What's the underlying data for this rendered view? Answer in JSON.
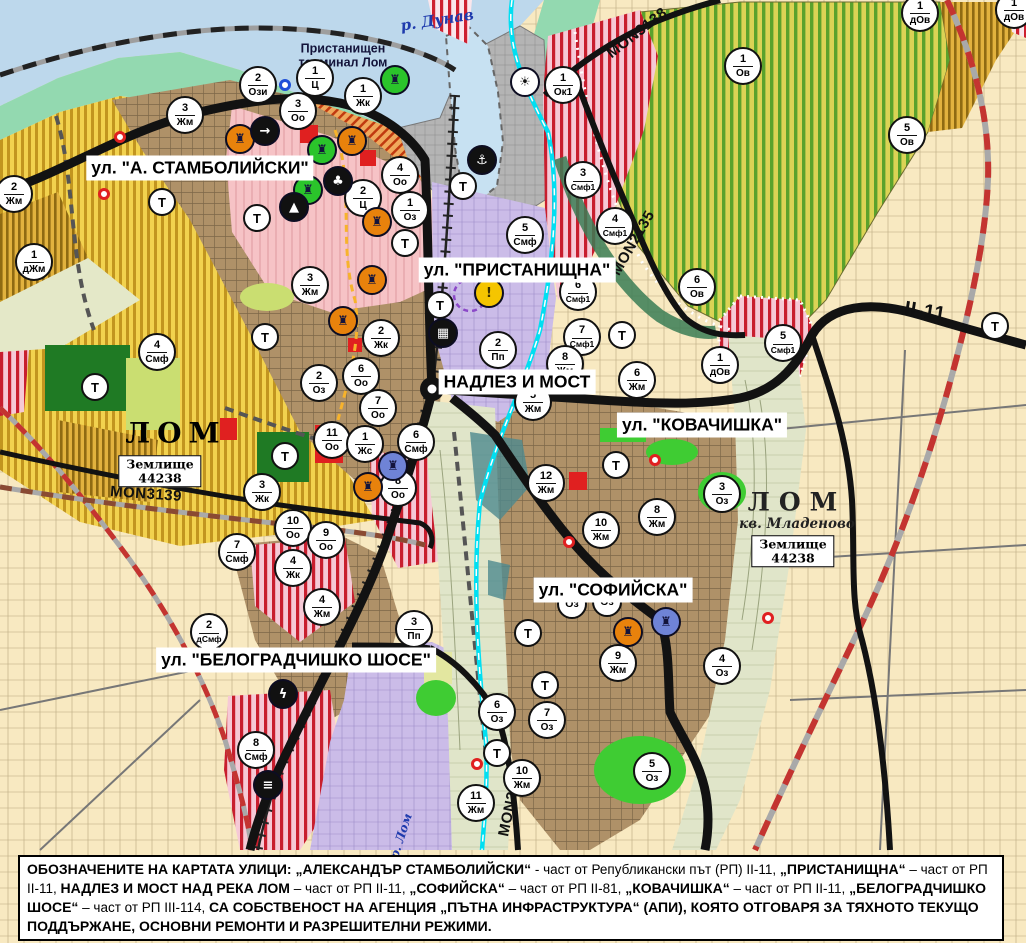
{
  "palette": {
    "water": "#BDD8EC",
    "shore_green": "#93D9B0",
    "port_gray": "#B4B4B4",
    "residential_yellow": "#F2D24E",
    "urban_brown": "#AF9168",
    "center_pink": "#F6C3C6",
    "mixed_red_stripe": "#CE2030",
    "industry_lavender": "#CBBCE8",
    "vineyard_green": "#5AA22C",
    "park_dark_green": "#1F7A24",
    "green_area": "#3FCC33",
    "valley_khaki": "#E0E5C9",
    "road_black": "#121212",
    "rail_red": "#C43430",
    "canal_cyan": "#00DFF2",
    "field_beige": "#F8E9C1"
  },
  "map": {
    "water_label": "р. Дунав",
    "river_lom_label": "р. Лом",
    "port_terminal_label": "Пристанищен\nтерминал Лом",
    "city": {
      "name": "ЛОМ"
    },
    "district": {
      "name": "ЛОМ",
      "sub": "кв. Младеново"
    },
    "land_plots": [
      {
        "line1": "Землище",
        "line2": "44238",
        "x": 160,
        "y": 471
      },
      {
        "line1": "Землище",
        "line2": "44238",
        "x": 793,
        "y": 551
      }
    ],
    "road_labels": [
      {
        "text": "MON3138",
        "x": 637,
        "y": 33,
        "rot": -38,
        "size": 15
      },
      {
        "text": "MON2135",
        "x": 633,
        "y": 243,
        "rot": -60,
        "size": 15
      },
      {
        "text": "MON3139",
        "x": 146,
        "y": 494,
        "rot": 4,
        "size": 15
      },
      {
        "text": "MON2136",
        "x": 511,
        "y": 801,
        "rot": -78,
        "size": 15
      },
      {
        "text": "II-11",
        "x": 925,
        "y": 312,
        "rot": 9,
        "size": 20
      }
    ],
    "street_labels": [
      {
        "text": "ул. \"А. СТАМБОЛИЙСКИ\"",
        "x": 200,
        "y": 168
      },
      {
        "text": "ул. \"ПРИСТАНИЩНА\"",
        "x": 517,
        "y": 270
      },
      {
        "text": "НАДЛЕЗ И МОСТ",
        "x": 517,
        "y": 382
      },
      {
        "text": "ул. \"КОВАЧИШКА\"",
        "x": 702,
        "y": 425
      },
      {
        "text": "ул. \"СОФИЙСКА\"",
        "x": 613,
        "y": 590
      },
      {
        "text": "ул. \"БЕЛОГРАДЧИШКО ШОСЕ\"",
        "x": 296,
        "y": 660
      }
    ],
    "markers": [
      {
        "num": "2",
        "code": "Ози",
        "x": 258,
        "y": 85
      },
      {
        "num": "1",
        "code": "Ц",
        "x": 315,
        "y": 78
      },
      {
        "num": "1",
        "code": "Жк",
        "x": 363,
        "y": 96
      },
      {
        "num": "3",
        "code": "Оо",
        "x": 298,
        "y": 111
      },
      {
        "num": "1",
        "code": "Ок1",
        "x": 563,
        "y": 85
      },
      {
        "num": "3",
        "code": "Жм",
        "x": 185,
        "y": 115
      },
      {
        "num": "2",
        "code": "Жм",
        "x": 14,
        "y": 194
      },
      {
        "num": "1",
        "code": "дЖм",
        "x": 34,
        "y": 262
      },
      {
        "num": "4",
        "code": "Оо",
        "x": 400,
        "y": 175
      },
      {
        "num": "2",
        "code": "Ц",
        "x": 363,
        "y": 198
      },
      {
        "num": "1",
        "code": "Оз",
        "x": 410,
        "y": 210
      },
      {
        "num": "3",
        "code": "Жм",
        "x": 310,
        "y": 285
      },
      {
        "num": "4",
        "code": "Смф",
        "x": 157,
        "y": 352
      },
      {
        "num": "3",
        "code": "Смф1",
        "x": 583,
        "y": 180
      },
      {
        "num": "4",
        "code": "Смф1",
        "x": 615,
        "y": 226
      },
      {
        "num": "5",
        "code": "Смф",
        "x": 525,
        "y": 235
      },
      {
        "num": "6",
        "code": "Смф1",
        "x": 578,
        "y": 292
      },
      {
        "num": "7",
        "code": "Смф1",
        "x": 582,
        "y": 337
      },
      {
        "num": "2",
        "code": "Пп",
        "x": 498,
        "y": 350
      },
      {
        "num": "2",
        "code": "Жк",
        "x": 381,
        "y": 338
      },
      {
        "num": "6",
        "code": "Оо",
        "x": 361,
        "y": 376
      },
      {
        "num": "2",
        "code": "Оз",
        "x": 319,
        "y": 383
      },
      {
        "num": "7",
        "code": "Оо",
        "x": 378,
        "y": 408
      },
      {
        "num": "11",
        "code": "Оо",
        "x": 332,
        "y": 440
      },
      {
        "num": "1",
        "code": "Жс",
        "x": 365,
        "y": 444
      },
      {
        "num": "6",
        "code": "Смф",
        "x": 416,
        "y": 442
      },
      {
        "num": "8",
        "code": "Оо",
        "x": 398,
        "y": 488
      },
      {
        "num": "3",
        "code": "Жк",
        "x": 262,
        "y": 492
      },
      {
        "num": "10",
        "code": "Оо",
        "x": 293,
        "y": 528
      },
      {
        "num": "9",
        "code": "Оо",
        "x": 326,
        "y": 540
      },
      {
        "num": "7",
        "code": "Смф",
        "x": 237,
        "y": 552
      },
      {
        "num": "4",
        "code": "Жк",
        "x": 293,
        "y": 568
      },
      {
        "num": "4",
        "code": "Жм",
        "x": 322,
        "y": 607
      },
      {
        "num": "2",
        "code": "дСмф",
        "x": 209,
        "y": 632
      },
      {
        "num": "3",
        "code": "Пп",
        "x": 414,
        "y": 629
      },
      {
        "num": "8",
        "code": "Смф",
        "x": 256,
        "y": 750
      },
      {
        "num": "5",
        "code": "Жм",
        "x": 533,
        "y": 402
      },
      {
        "num": "8",
        "code": "Жм",
        "x": 565,
        "y": 364
      },
      {
        "num": "6",
        "code": "Жм",
        "x": 637,
        "y": 380
      },
      {
        "num": "12",
        "code": "Жм",
        "x": 546,
        "y": 483
      },
      {
        "num": "10",
        "code": "Жм",
        "x": 601,
        "y": 530
      },
      {
        "num": "8",
        "code": "Жм",
        "x": 657,
        "y": 517
      },
      {
        "num": "3",
        "code": "Оз",
        "x": 722,
        "y": 494
      },
      {
        "num": "10",
        "code": "Жм",
        "x": 522,
        "y": 778
      },
      {
        "num": "11",
        "code": "Жм",
        "x": 476,
        "y": 803
      },
      {
        "num": "9",
        "code": "Жм",
        "x": 618,
        "y": 663
      },
      {
        "num": "6",
        "code": "Оз",
        "x": 497,
        "y": 712
      },
      {
        "num": "7",
        "code": "Оз",
        "x": 547,
        "y": 720
      },
      {
        "num": "5",
        "code": "Оз",
        "x": 652,
        "y": 771
      },
      {
        "num": "4",
        "code": "Оз",
        "x": 722,
        "y": 666
      },
      {
        "num": "1",
        "code": "Ов",
        "x": 743,
        "y": 66
      },
      {
        "num": "5",
        "code": "Ов",
        "x": 907,
        "y": 135
      },
      {
        "num": "6",
        "code": "Ов",
        "x": 697,
        "y": 287
      },
      {
        "num": "1",
        "code": "дОв",
        "x": 920,
        "y": 13
      },
      {
        "num": "1",
        "code": "дОв",
        "x": 1014,
        "y": 10
      },
      {
        "num": "1",
        "code": "дОв",
        "x": 720,
        "y": 365
      },
      {
        "num": "5",
        "code": "Смф1",
        "x": 783,
        "y": 343
      },
      {
        "num": "",
        "code": "Оз",
        "x": 572,
        "y": 604
      },
      {
        "num": "",
        "code": "Оз",
        "x": 607,
        "y": 602
      }
    ],
    "t_markers": [
      {
        "x": 162,
        "y": 202
      },
      {
        "x": 257,
        "y": 218
      },
      {
        "x": 265,
        "y": 337
      },
      {
        "x": 95,
        "y": 387
      },
      {
        "x": 285,
        "y": 456
      },
      {
        "x": 463,
        "y": 186
      },
      {
        "x": 405,
        "y": 243
      },
      {
        "x": 440,
        "y": 305
      },
      {
        "x": 622,
        "y": 335
      },
      {
        "x": 616,
        "y": 465
      },
      {
        "x": 528,
        "y": 633
      },
      {
        "x": 545,
        "y": 685
      },
      {
        "x": 497,
        "y": 753
      },
      {
        "x": 995,
        "y": 326
      }
    ],
    "icons": [
      {
        "type": "monument",
        "x": 240,
        "y": 139,
        "bg": "#E8820C",
        "fg": "#14143C",
        "glyph": "♜"
      },
      {
        "type": "monument",
        "x": 352,
        "y": 141,
        "bg": "#E8820C",
        "fg": "#14143C",
        "glyph": "♜"
      },
      {
        "type": "monument",
        "x": 377,
        "y": 222,
        "bg": "#E8820C",
        "fg": "#14143C",
        "glyph": "♜"
      },
      {
        "type": "monument",
        "x": 372,
        "y": 280,
        "bg": "#E8820C",
        "fg": "#14143C",
        "glyph": "♜"
      },
      {
        "type": "monument",
        "x": 343,
        "y": 321,
        "bg": "#E8820C",
        "fg": "#14143C",
        "glyph": "♜"
      },
      {
        "type": "monument",
        "x": 368,
        "y": 487,
        "bg": "#E8820C",
        "fg": "#14143C",
        "glyph": "♜"
      },
      {
        "type": "monument",
        "x": 628,
        "y": 632,
        "bg": "#E8820C",
        "fg": "#14143C",
        "glyph": "♜"
      },
      {
        "type": "monument",
        "x": 395,
        "y": 80,
        "bg": "#2BC42B",
        "fg": "#14143C",
        "glyph": "♜"
      },
      {
        "type": "monument",
        "x": 322,
        "y": 150,
        "bg": "#2BC42B",
        "fg": "#14143C",
        "glyph": "♜"
      },
      {
        "type": "monument",
        "x": 308,
        "y": 190,
        "bg": "#2BC42B",
        "fg": "#14143C",
        "glyph": "♜"
      },
      {
        "type": "monument",
        "x": 393,
        "y": 466,
        "bg": "#6F83D6",
        "fg": "#14143C",
        "glyph": "♜"
      },
      {
        "type": "monument",
        "x": 666,
        "y": 622,
        "bg": "#6F83D6",
        "fg": "#14143C",
        "glyph": "♜"
      },
      {
        "type": "circle-arrow",
        "x": 265,
        "y": 131,
        "bg": "#111111",
        "fg": "#ffffff",
        "glyph": "→"
      },
      {
        "type": "club",
        "x": 338,
        "y": 181,
        "bg": "#111111",
        "fg": "#ffffff",
        "glyph": "♣"
      },
      {
        "type": "tunnel",
        "x": 294,
        "y": 207,
        "bg": "#111111",
        "fg": "#ffffff",
        "glyph": "▲"
      },
      {
        "type": "anchor",
        "x": 482,
        "y": 160,
        "bg": "#111111",
        "fg": "#ffffff",
        "glyph": "⚓"
      },
      {
        "type": "sun",
        "x": 525,
        "y": 82,
        "bg": "#ffffff",
        "fg": "#111111",
        "glyph": "☀"
      },
      {
        "type": "warning",
        "x": 489,
        "y": 293,
        "bg": "#F5C500",
        "fg": "#3A3000",
        "glyph": "!"
      },
      {
        "type": "bus",
        "x": 443,
        "y": 333,
        "bg": "#111111",
        "fg": "#ffffff",
        "glyph": "▦"
      },
      {
        "type": "lightning",
        "x": 283,
        "y": 694,
        "bg": "#111111",
        "fg": "#ffffff",
        "glyph": "ϟ"
      },
      {
        "type": "railway-station",
        "x": 268,
        "y": 785,
        "bg": "#111111",
        "fg": "#ffffff",
        "glyph": "≡"
      }
    ],
    "points": [
      {
        "x": 120,
        "y": 137,
        "color": "#E02020"
      },
      {
        "x": 104,
        "y": 194,
        "color": "#E02020"
      },
      {
        "x": 655,
        "y": 460,
        "color": "#E02020"
      },
      {
        "x": 569,
        "y": 542,
        "color": "#E02020"
      },
      {
        "x": 768,
        "y": 618,
        "color": "#E02020"
      },
      {
        "x": 477,
        "y": 764,
        "color": "#E02020"
      },
      {
        "x": 285,
        "y": 85,
        "color": "#1F4FD8"
      }
    ]
  },
  "legend_bar": {
    "segments": [
      {
        "text": "ОБОЗНАЧЕНИТЕ НА КАРТАТА УЛИЦИ: „АЛЕКСАНДЪР СТАМБОЛИЙСКИ“",
        "bold": true
      },
      {
        "text": " - част от Републикански път (РП) II-11, ",
        "bold": false
      },
      {
        "text": "„ПРИСТАНИЩНА“",
        "bold": true
      },
      {
        "text": " – част от РП II-11, ",
        "bold": false
      },
      {
        "text": "НАДЛЕЗ И МОСТ НАД РЕКА ЛОМ",
        "bold": true
      },
      {
        "text": " – част от РП II-11, ",
        "bold": false
      },
      {
        "text": "„СОФИЙСКА“",
        "bold": true
      },
      {
        "text": " – част от РП II-81, ",
        "bold": false
      },
      {
        "text": "„КОВАЧИШКА“",
        "bold": true
      },
      {
        "text": " – част от РП II-11, ",
        "bold": false
      },
      {
        "text": "„БЕЛОГРАДЧИШКО ШОСЕ“",
        "bold": true
      },
      {
        "text": " – част от РП III-114, ",
        "bold": false
      },
      {
        "text": "СА СОБСТВЕНОСТ НА АГЕНЦИЯ „ПЪТНА ИНФРАСТРУКТУРА“ (АПИ), КОЯТО ОТГОВАРЯ ЗА ТЯХНОТО ТЕКУЩО ПОДДЪРЖАНЕ, ОСНОВНИ РЕМОНТИ И РАЗРЕШИТЕЛНИ РЕЖИМИ.",
        "bold": true
      }
    ]
  }
}
